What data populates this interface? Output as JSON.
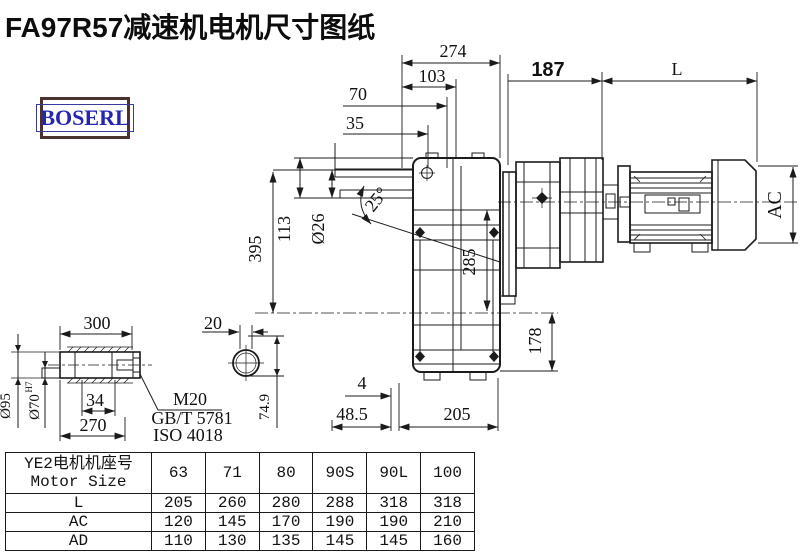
{
  "title": "FA97R57减速机电机尺寸图纸",
  "logo": {
    "text": "BOSERL"
  },
  "dims": {
    "d274": "274",
    "d103": "103",
    "d70": "70",
    "d35": "35",
    "d187": "187",
    "dL": "L",
    "d395": "395",
    "d113": "113",
    "d26": "Ø26",
    "d25": "25°",
    "d285": "285",
    "d178": "178",
    "dAC": "AC",
    "d4": "4",
    "d48_5": "48.5",
    "d205": "205",
    "d300": "300",
    "d20": "20",
    "d95": "Ø95",
    "d70_main": "Ø70",
    "d70_sup": "H7",
    "d34": "34",
    "d270": "270",
    "d74_9": "74.9",
    "thread": "M20",
    "std1": "GB/T 5781",
    "std2": "ISO 4018"
  },
  "table": {
    "header_cn": "YE2电机机座号",
    "header_en": "Motor Size",
    "columns": [
      "63",
      "71",
      "80",
      "90S",
      "90L",
      "100"
    ],
    "rows": [
      {
        "label": "L",
        "values": [
          "205",
          "260",
          "280",
          "288",
          "318",
          "318"
        ]
      },
      {
        "label": "AC",
        "values": [
          "120",
          "145",
          "170",
          "190",
          "190",
          "210"
        ]
      },
      {
        "label": "AD",
        "values": [
          "110",
          "130",
          "135",
          "145",
          "145",
          "160"
        ]
      }
    ]
  },
  "colors": {
    "line": "#1b1b1b",
    "logo_text": "#2525b4",
    "logo_border": "#4a332c"
  }
}
